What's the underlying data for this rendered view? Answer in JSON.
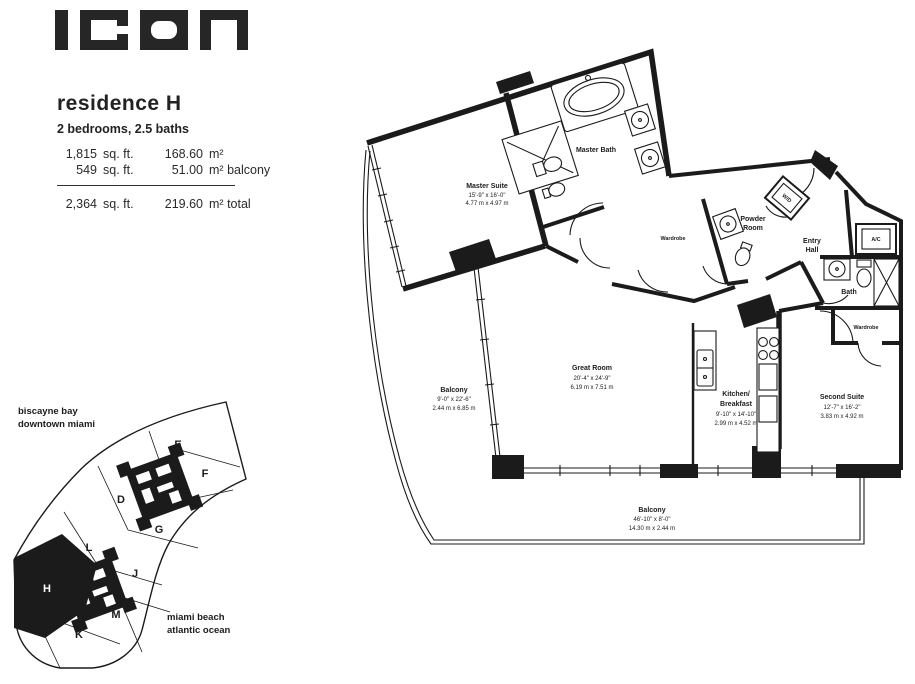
{
  "brand": {
    "logo_text": "ICON"
  },
  "header": {
    "title": "residence H",
    "subtitle": "2 bedrooms, 2.5 baths",
    "areas": [
      {
        "imperial": "1,815",
        "imperial_unit": "sq. ft.",
        "metric": "168.60",
        "metric_unit": "m²",
        "note": ""
      },
      {
        "imperial": "549",
        "imperial_unit": "sq. ft.",
        "metric": "51.00",
        "metric_unit": "m²",
        "note": "balcony"
      }
    ],
    "total": {
      "imperial": "2,364",
      "imperial_unit": "sq. ft.",
      "metric": "219.60",
      "metric_unit": "m²",
      "note": "total"
    }
  },
  "plan": {
    "rooms": {
      "master_suite": {
        "name": "Master Suite",
        "dim_imperial": "15'-9\" x 16'-0\"",
        "dim_metric": "4.77 m x 4.97 m"
      },
      "master_bath": {
        "name": "Master Bath"
      },
      "wardrobe_master": {
        "name": "Wardrobe"
      },
      "powder_room": {
        "name_line1": "Powder",
        "name_line2": "Room"
      },
      "wd_closet": {
        "name": "W/D"
      },
      "entry_hall": {
        "name_line1": "Entry",
        "name_line2": "Hall"
      },
      "ac_closet": {
        "name": "A/C"
      },
      "bath": {
        "name": "Bath"
      },
      "wardrobe_second": {
        "name": "Wardrobe"
      },
      "second_suite": {
        "name": "Second Suite",
        "dim_imperial": "12'-7\" x 16'-2\"",
        "dim_metric": "3.83 m x 4.92 m"
      },
      "kitchen": {
        "name_line1": "Kitchen/",
        "name_line2": "Breakfast",
        "dim_imperial": "9'-10\" x 14'-10\"",
        "dim_metric": "2.99 m x 4.52 m"
      },
      "great_room": {
        "name": "Great Room",
        "dim_imperial": "20'-4\" x 24'-9\"",
        "dim_metric": "6.19 m x 7.51 m"
      },
      "balcony_west": {
        "name": "Balcony",
        "dim_imperial": "9'-0\" x 22'-6\"",
        "dim_metric": "2.44 m x 6.85 m"
      },
      "balcony_south": {
        "name": "Balcony",
        "dim_imperial": "46'-10\" x 8'-0\"",
        "dim_metric": "14.30 m x 2.44 m"
      }
    }
  },
  "keyplan": {
    "context_top_line1": "biscayne bay",
    "context_top_line2": "downtown miami",
    "context_bottom_line1": "miami beach",
    "context_bottom_line2": "atlantic ocean",
    "units": [
      "E",
      "F",
      "D",
      "G",
      "L",
      "J",
      "H",
      "M",
      "K"
    ],
    "highlighted_unit": "H"
  },
  "colors": {
    "ink": "#1b1b1b",
    "paper": "#ffffff"
  }
}
